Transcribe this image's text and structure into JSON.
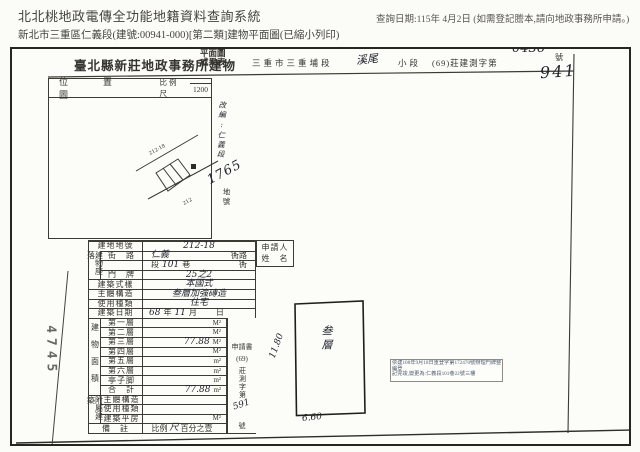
{
  "app": {
    "title": "北北桃地政電傳全功能地籍資料查詢系統",
    "query_date": "查詢日期:115年 4月2日 (如需登記謄本,請向地政事務所申請。)",
    "subtitle": "新北市三重區仁義段(建號:00941-000)[第二類]建物平面圖(已縮小列印)"
  },
  "doc": {
    "office": "臺北縣新莊地政事務所建物",
    "title_top": "平面圖",
    "title_bottom": "成果表",
    "section_prefix": "三重市三重埔段",
    "subsection_hw": "溪尾",
    "subsection_label": "小段",
    "doc_no_prefix": "(69)莊建測字第",
    "doc_no_hw": "0436",
    "doc_no_suffix": "號",
    "building_no_hw": "941",
    "file_no_stamp": "4745",
    "location_map": {
      "label": "位　置　圖",
      "scale_label": "比例尺",
      "scale_value": "1200",
      "parcel_sketch_label": "212-18",
      "note_hw": "改編:仁義段",
      "parcel_no_hw": "1765",
      "parcel_no_suffix": "地號"
    },
    "form": {
      "lot": {
        "label": "建地地號",
        "value": "212-18"
      },
      "situs_group": "建物座落",
      "street": {
        "label": "街　路",
        "value": "仁義",
        "suffix": "衖路"
      },
      "lane": {
        "pre": "段",
        "value": "101",
        "mid": "巷",
        "suffix": "衖"
      },
      "door": {
        "label": "門　牌",
        "value": "25之2"
      },
      "style": {
        "label": "建築式樣",
        "value": "本國式"
      },
      "structure": {
        "label": "主體構造",
        "value": "叁層加強磚造"
      },
      "usage": {
        "label": "使用種類",
        "value": "住宅"
      },
      "date": {
        "label": "建築日期",
        "year": "68",
        "year_u": "年",
        "month": "11",
        "month_u": "月",
        "day_u": "日"
      },
      "area_group": "建物面積",
      "floors": [
        {
          "label": "第一層",
          "value": "",
          "unit": "M²"
        },
        {
          "label": "第二層",
          "value": "",
          "unit": "M²"
        },
        {
          "label": "第三層",
          "value": "77.88",
          "unit": "M²"
        },
        {
          "label": "第四層",
          "value": "",
          "unit": "M²"
        },
        {
          "label": "第五層",
          "value": "",
          "unit": "m²"
        },
        {
          "label": "第六層",
          "value": "",
          "unit": "m²"
        },
        {
          "label": "亭子脚",
          "value": "",
          "unit": "m²"
        },
        {
          "label": "合　計",
          "value": "77.88",
          "unit": "m²"
        }
      ],
      "annex_group": "附屬建築",
      "annex": [
        {
          "label": "主體構造",
          "value": "",
          "unit": ""
        },
        {
          "label": "使用種類",
          "value": "",
          "unit": ""
        },
        {
          "label": "建築平房",
          "value": "",
          "unit": "M²"
        }
      ],
      "remarks": {
        "label": "備　註",
        "pre": "比例",
        "hw": "尺",
        "post": "百分之壹"
      },
      "applicant": {
        "line1": "申請人",
        "line2": "姓　名"
      },
      "application": {
        "line1": "申請書",
        "line2": "(69)",
        "vertical": "莊測字第",
        "hw": "591",
        "suffix": "號"
      }
    },
    "plan": {
      "floor_hw": "叁層",
      "height_dim": "11.80",
      "width_dim": "6.60"
    },
    "stamp": {
      "line1": "依建108年9月18日重登字第172470號辦理門牌整編登",
      "line2": "記完竣,變更為:仁義段101巷22號三樓"
    }
  },
  "colors": {
    "ink": "#22242e",
    "print": "#35342e",
    "stamp_text": "#515e6e",
    "border": "#3c3b33"
  }
}
